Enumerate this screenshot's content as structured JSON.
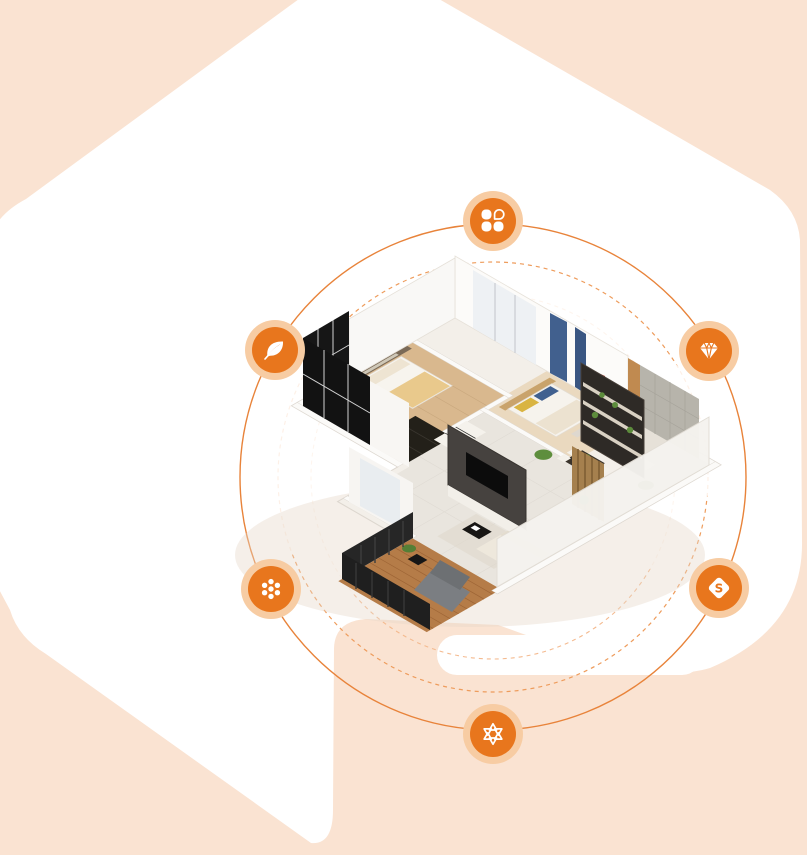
{
  "page": {
    "width": 807,
    "height": 855,
    "alt": "Decorative hero section: 3D isometric apartment floor plan with orbiting feature icons"
  },
  "colors": {
    "peach": "#FAE3D2",
    "panel_white": "#FFFFFF",
    "icon_fill": "#E8761D",
    "icon_ring": "#F7CCA3",
    "orbit_solid": "#E8833A",
    "orbit_dashed": "#EE9C5C",
    "orbit_dashed_inner": "#F4BA8F"
  },
  "orbit": {
    "center_x": 493,
    "center_y": 477,
    "solid_radius": 253,
    "dashed_radius": 215,
    "inner_dashed_radius": 182
  },
  "icons": [
    {
      "name": "clover-icon",
      "glyph": "clover",
      "x": 493,
      "y": 221
    },
    {
      "name": "leaf-icon",
      "glyph": "leaf",
      "x": 275,
      "y": 350
    },
    {
      "name": "gem-icon",
      "glyph": "gem",
      "x": 709,
      "y": 351
    },
    {
      "name": "dots-icon",
      "glyph": "dots",
      "x": 271,
      "y": 589
    },
    {
      "name": "s-gem-icon",
      "glyph": "s-gem",
      "x": 719,
      "y": 588,
      "letter": "S"
    },
    {
      "name": "triangles-icon",
      "glyph": "triangles",
      "x": 493,
      "y": 734
    }
  ],
  "floorplan": {
    "alt": "3D cutaway render of a furnished apartment: bedrooms upper left, living room with TV wall, display shelving, dining set and wooden balcony with lounge chair"
  }
}
